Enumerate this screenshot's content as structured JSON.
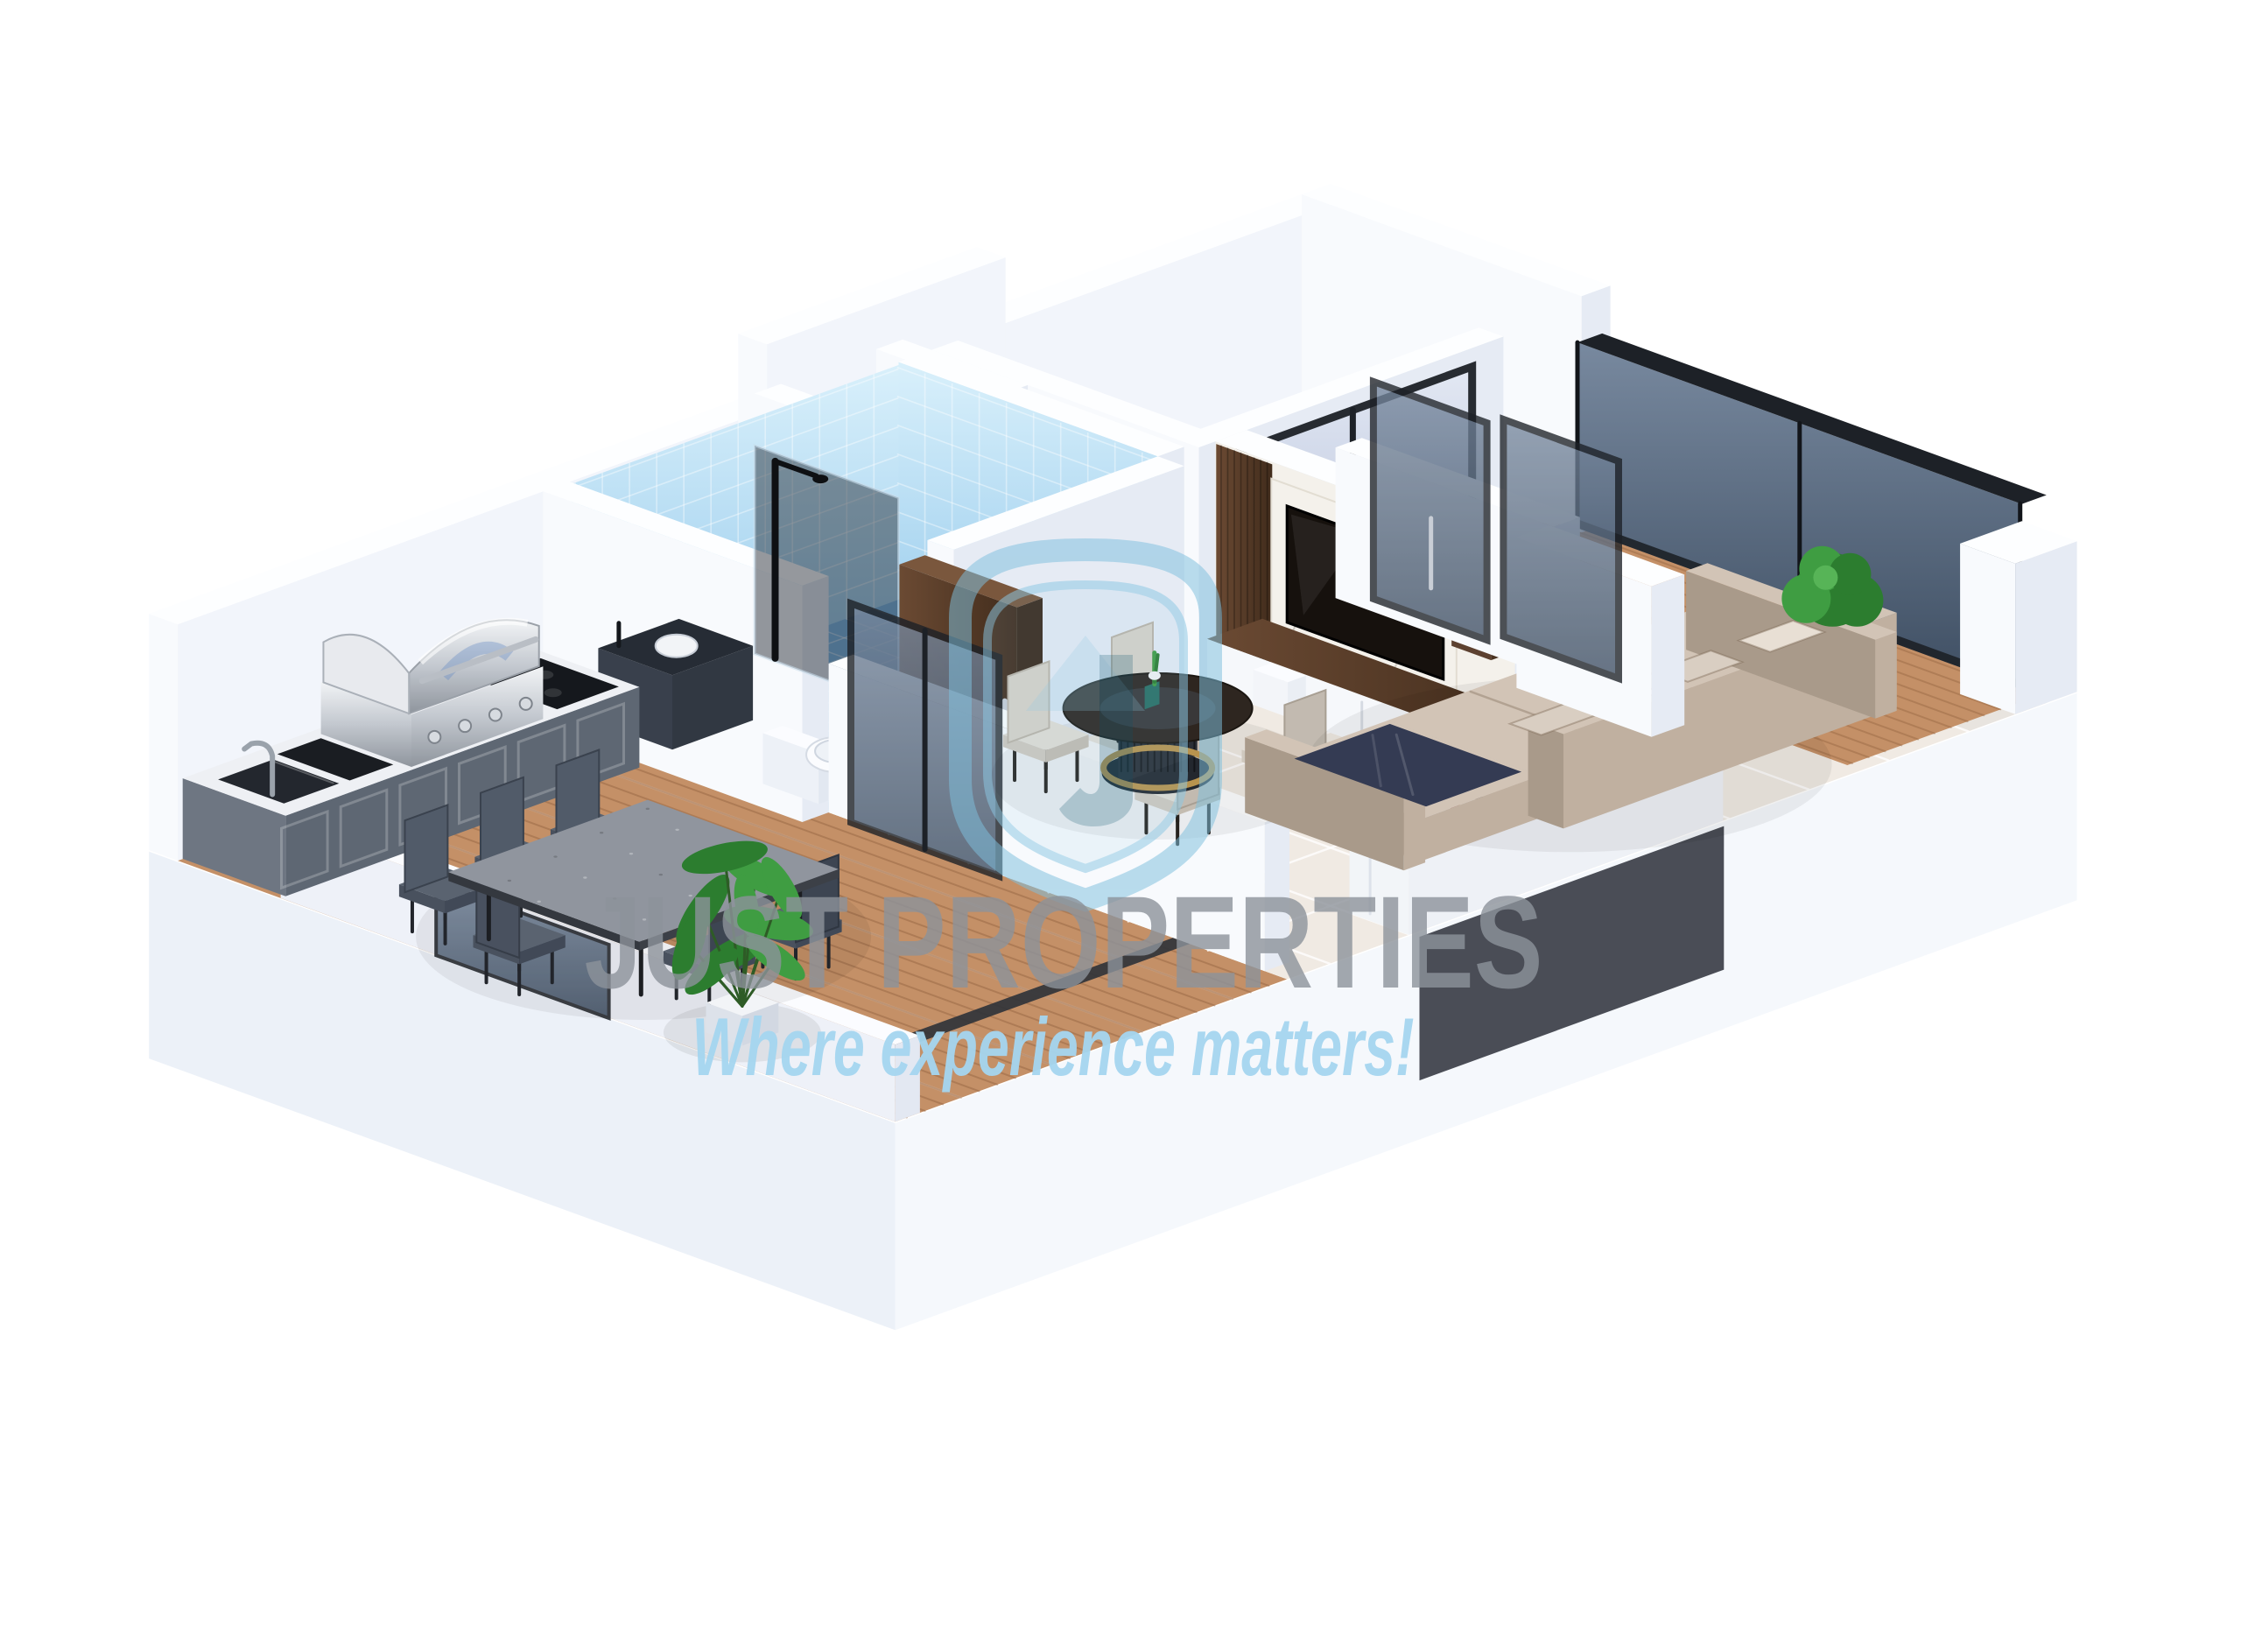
{
  "image": {
    "kind": "3d-floor-plan-render",
    "style": "isometric dollhouse cutaway, single-bedroom apartment",
    "background": "#ffffff"
  },
  "watermark": {
    "brand": "JUST PROPERTIES",
    "tagline": "Where experience matters!",
    "logo": "shield-jp-logo",
    "brand_color": "#8d939b",
    "tagline_color": "#a3d4ef",
    "logo_color": "#7fc0de"
  },
  "colors": {
    "wall": "#f8fafd",
    "wallTop": "#fdfeff",
    "wallShade": "#e6ebf4",
    "wallInner": "#f2f5fb",
    "skirtL": "#ecf1f8",
    "skirtR": "#f5f8fc",
    "tile": "#f0eae3",
    "tileLine": "#ffffff",
    "bathFloor": "#7db6e4",
    "bathW1": "#c9e8f9",
    "bathW2": "#8fc6ea",
    "deck": "#c49067",
    "deckLine": "#8a5a38",
    "glass1": "#73859c",
    "glass2": "#3e4e62",
    "frame": "#1d2127",
    "frost1": "#dfe5f2",
    "frost2": "#b2bfd9",
    "steel1": "#edeff2",
    "steel2": "#9aa0a8",
    "counterGray1": "#6e7682",
    "counterGray2": "#5e6773",
    "countertop": "#eef0f4",
    "marble": "#f4f1eb",
    "woodD1": "#6b4a33",
    "woodD2": "#46301f",
    "tv": "#16110d",
    "sofa1": "#c0b0a0",
    "sofa2": "#d2c4b6",
    "sofa3": "#a99a8a",
    "navy": "#343b53",
    "chairDark": "#4e5766",
    "chairCream": "#dad4cb",
    "tableDark": "#2e2620",
    "gold": "#b8934e",
    "green1": "#3f9d42",
    "green2": "#2c7d2f",
    "islandTop": "#e9ddc6",
    "stone": "#90959e",
    "lw1": "#efe5d2",
    "lw2": "#dccdb0"
  },
  "scene": {
    "rooms": [
      {
        "name": "outdoor-patio",
        "floor": "wood-deck",
        "features": [
          "outdoor-kitchen-counter",
          "bbq-grill",
          "outdoor-sink",
          "cooktop",
          "cutting-board",
          "dining-table-six-chairs",
          "potted-plant",
          "glass-parapet-panel"
        ]
      },
      {
        "name": "bathroom",
        "walls": "blue-tile",
        "features": [
          "walk-in-shower",
          "glass-shower-screen",
          "toilet",
          "dark-vanity",
          "walnut-door"
        ]
      },
      {
        "name": "bedroom",
        "walls": "white",
        "features": [
          "frosted-glass-sliding-doors"
        ]
      },
      {
        "name": "hallway",
        "features": [
          "closet-niche"
        ]
      },
      {
        "name": "dining-area",
        "floor": "cream-tile",
        "features": [
          "round-dark-table",
          "gold-base-ring",
          "four-cream-chairs",
          "green-centerpiece"
        ]
      },
      {
        "name": "kitchen",
        "floor": "cream-tile",
        "features": [
          "island-counter",
          "undermount-sink",
          "chrome-faucet",
          "wine-rack",
          "cookie-jars",
          "dark-runner"
        ]
      },
      {
        "name": "living-room",
        "floor": "cream-tile",
        "features": [
          "beige-sectional-sofa",
          "navy-throw",
          "pillows",
          "tv-media-wall",
          "marble-panel",
          "wood-slats",
          "floating-shelves",
          "small-plants",
          "white-base-cabinet"
        ]
      },
      {
        "name": "balcony",
        "floor": "wood-deck",
        "features": [
          "dark-glass-balustrade",
          "sliding-glass-doors",
          "green-shrub",
          "white-parapet"
        ]
      }
    ]
  }
}
